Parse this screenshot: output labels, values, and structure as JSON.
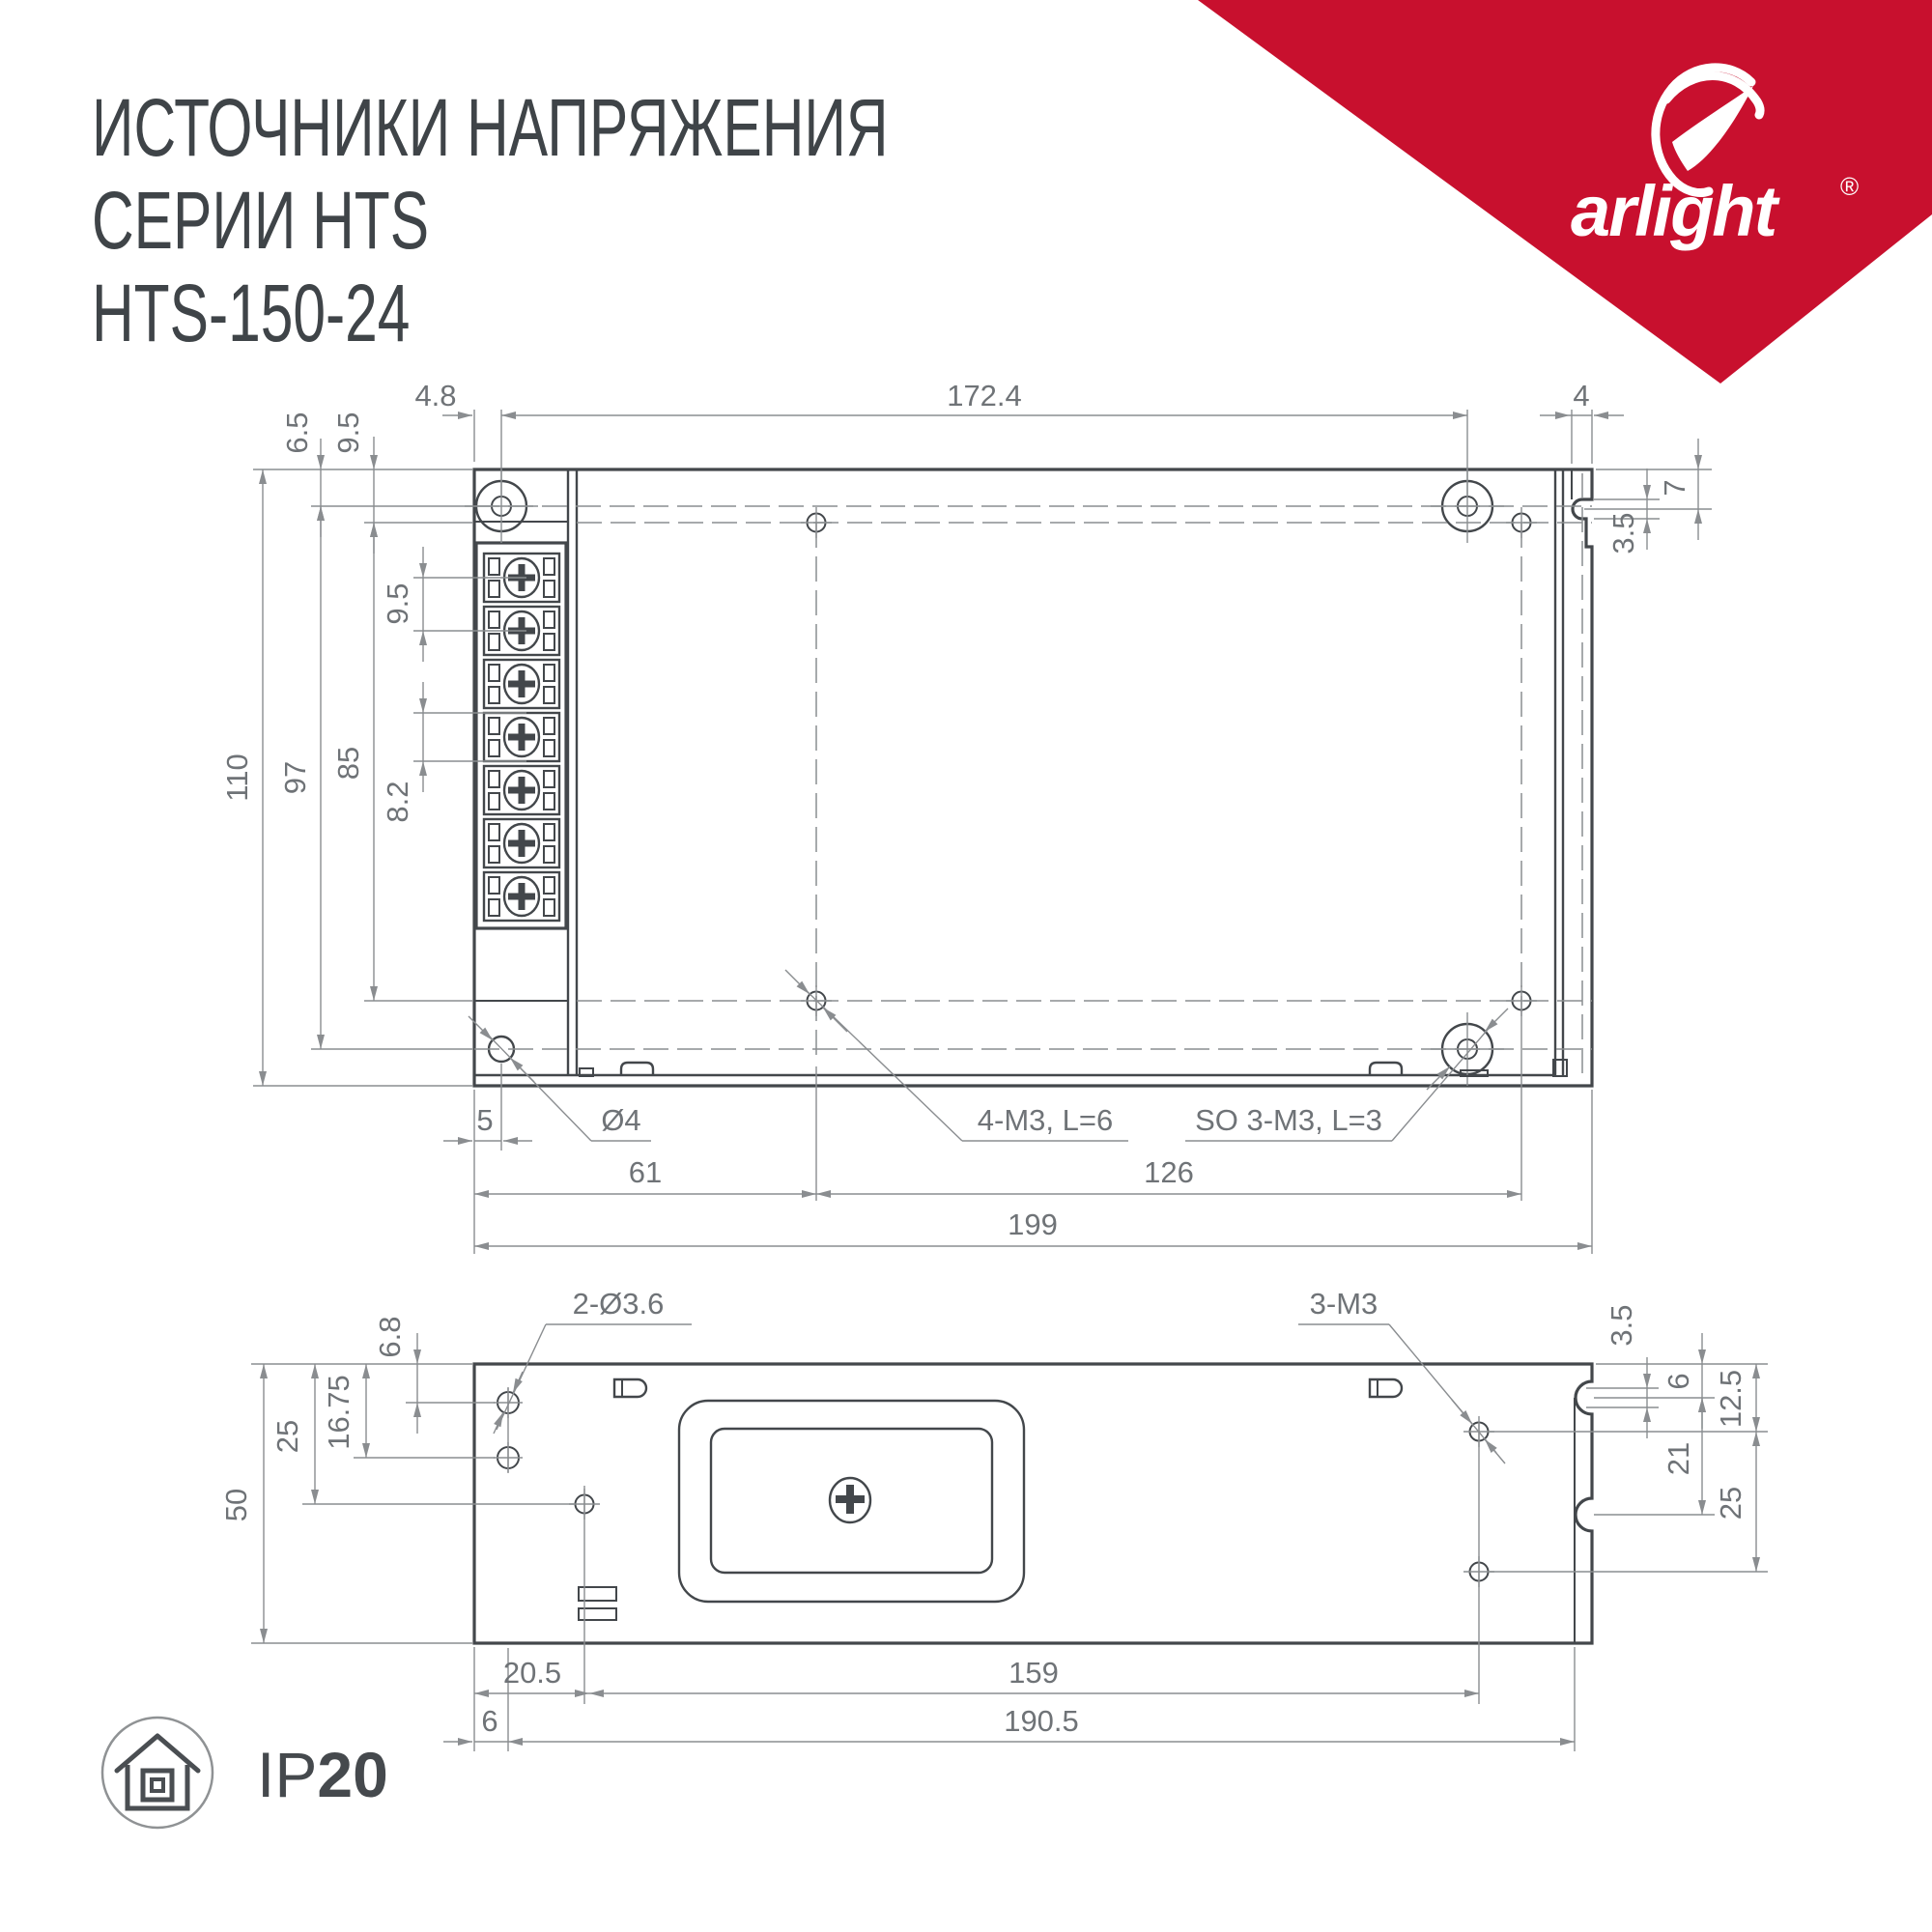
{
  "header": {
    "title_line1": "ИСТОЧНИКИ НАПРЯЖЕНИЯ",
    "title_line2": "СЕРИИ HTS",
    "title_line3": "HTS-150-24"
  },
  "brand": {
    "name": "arlight",
    "registered_mark": "®",
    "banner_color": "#c8102e"
  },
  "ip_badge": {
    "prefix": "IP",
    "rating": "20"
  },
  "top_view": {
    "dims": {
      "top_offset_x": "4.8",
      "mount_span_x": "172.4",
      "flange_width": "4",
      "hole_row_top": "6.5",
      "hole_row_second": "9.5",
      "slot_depth": "7",
      "slot_width": "3.5",
      "case_height": "110",
      "mount_span_y": "97",
      "inner_span_y": "85",
      "terminal_pitch": "9.5",
      "terminal_cell": "8.2",
      "corner_hole_offset": "5",
      "corner_hole_dia": "Ø4",
      "bottom_span_left": "61",
      "bottom_span_mid": "126",
      "case_length": "199",
      "callout_m3": "4-M3, L=6",
      "callout_standoff": "SO 3-M3, L=3"
    }
  },
  "bottom_view": {
    "dims": {
      "callout_side_holes": "2-Ø3.6",
      "callout_m3": "3-M3",
      "hole1_offset": "6.8",
      "hole2_offset": "16.75",
      "hole3_offset": "25",
      "case_height": "50",
      "slot_width": "3.5",
      "slot_center": "6",
      "hole_row1": "12.5",
      "slot_pitch": "21",
      "hole_row2": "25",
      "bottom_left_offset": "20.5",
      "bottom_span": "159",
      "side_hole_offset": "6",
      "bottom_total": "190.5"
    }
  }
}
